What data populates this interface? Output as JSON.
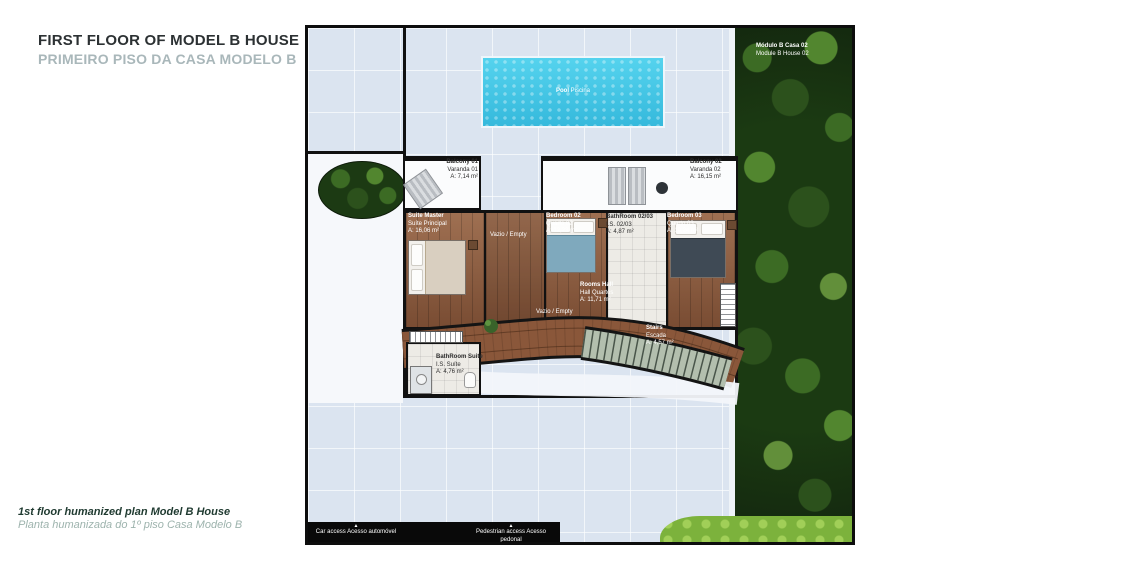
{
  "header": {
    "title": "FIRST FLOOR OF MODEL B HOUSE",
    "subtitle": "PRIMEIRO PISO DA CASA MODELO B"
  },
  "footer": {
    "caption_en": "1st floor humanized plan Model B House",
    "caption_pt": "Planta humanizada do 1º piso Casa Modelo B"
  },
  "plan": {
    "module": {
      "line1": "Módulo B Casa 02",
      "line2": "Module B House 02"
    },
    "pool": {
      "line1": "Pool",
      "line2": "Piscina"
    },
    "void_label": "Vazio / Empty",
    "rooms": [
      {
        "id": "balcony-01",
        "line1": "Balcony 01",
        "line2": "Varanda 01",
        "area": "A: 7,14 m²"
      },
      {
        "id": "balcony-02",
        "line1": "Balcony 02",
        "line2": "Varanda 02",
        "area": "A: 16,15 m²"
      },
      {
        "id": "suite-master",
        "line1": "Suite Master",
        "line2": "Suíte Principal",
        "area": "A: 16,06 m²"
      },
      {
        "id": "bedroom-02",
        "line1": "Bedroom 02",
        "line2": "Quarto 02",
        "area": "A: 12,23 m²"
      },
      {
        "id": "bathroom-02-03",
        "line1": "BathRoom 02/03",
        "line2": "I.S. 02/03",
        "area": "A: 4,87 m²"
      },
      {
        "id": "bedroom-03",
        "line1": "Bedroom 03",
        "line2": "Quarto 03",
        "area": "A: 10,24 m²"
      },
      {
        "id": "rooms-hall",
        "line1": "Rooms Hall",
        "line2": "Hall Quartos",
        "area": "A: 11,71 m²"
      },
      {
        "id": "bathroom-suite",
        "line1": "BathRoom Suite",
        "line2": "I.S. Suíte",
        "area": "A: 4,76 m²"
      },
      {
        "id": "stairs",
        "line1": "Stairs",
        "line2": "Escada",
        "area": "A: 4,57 m²"
      }
    ],
    "access": {
      "car": {
        "line1": "Car access",
        "line2": "Acesso automóvel"
      },
      "pedestrian": {
        "line1": "Pedestrian access",
        "line2": "Acesso pedonal"
      }
    }
  },
  "colors": {
    "wood": "#8a573a",
    "pool_water": "#41c4e4",
    "tree_green": "#223f16",
    "lawn_green": "#7cb23c",
    "subtitle_gray": "#a9b7ba"
  }
}
